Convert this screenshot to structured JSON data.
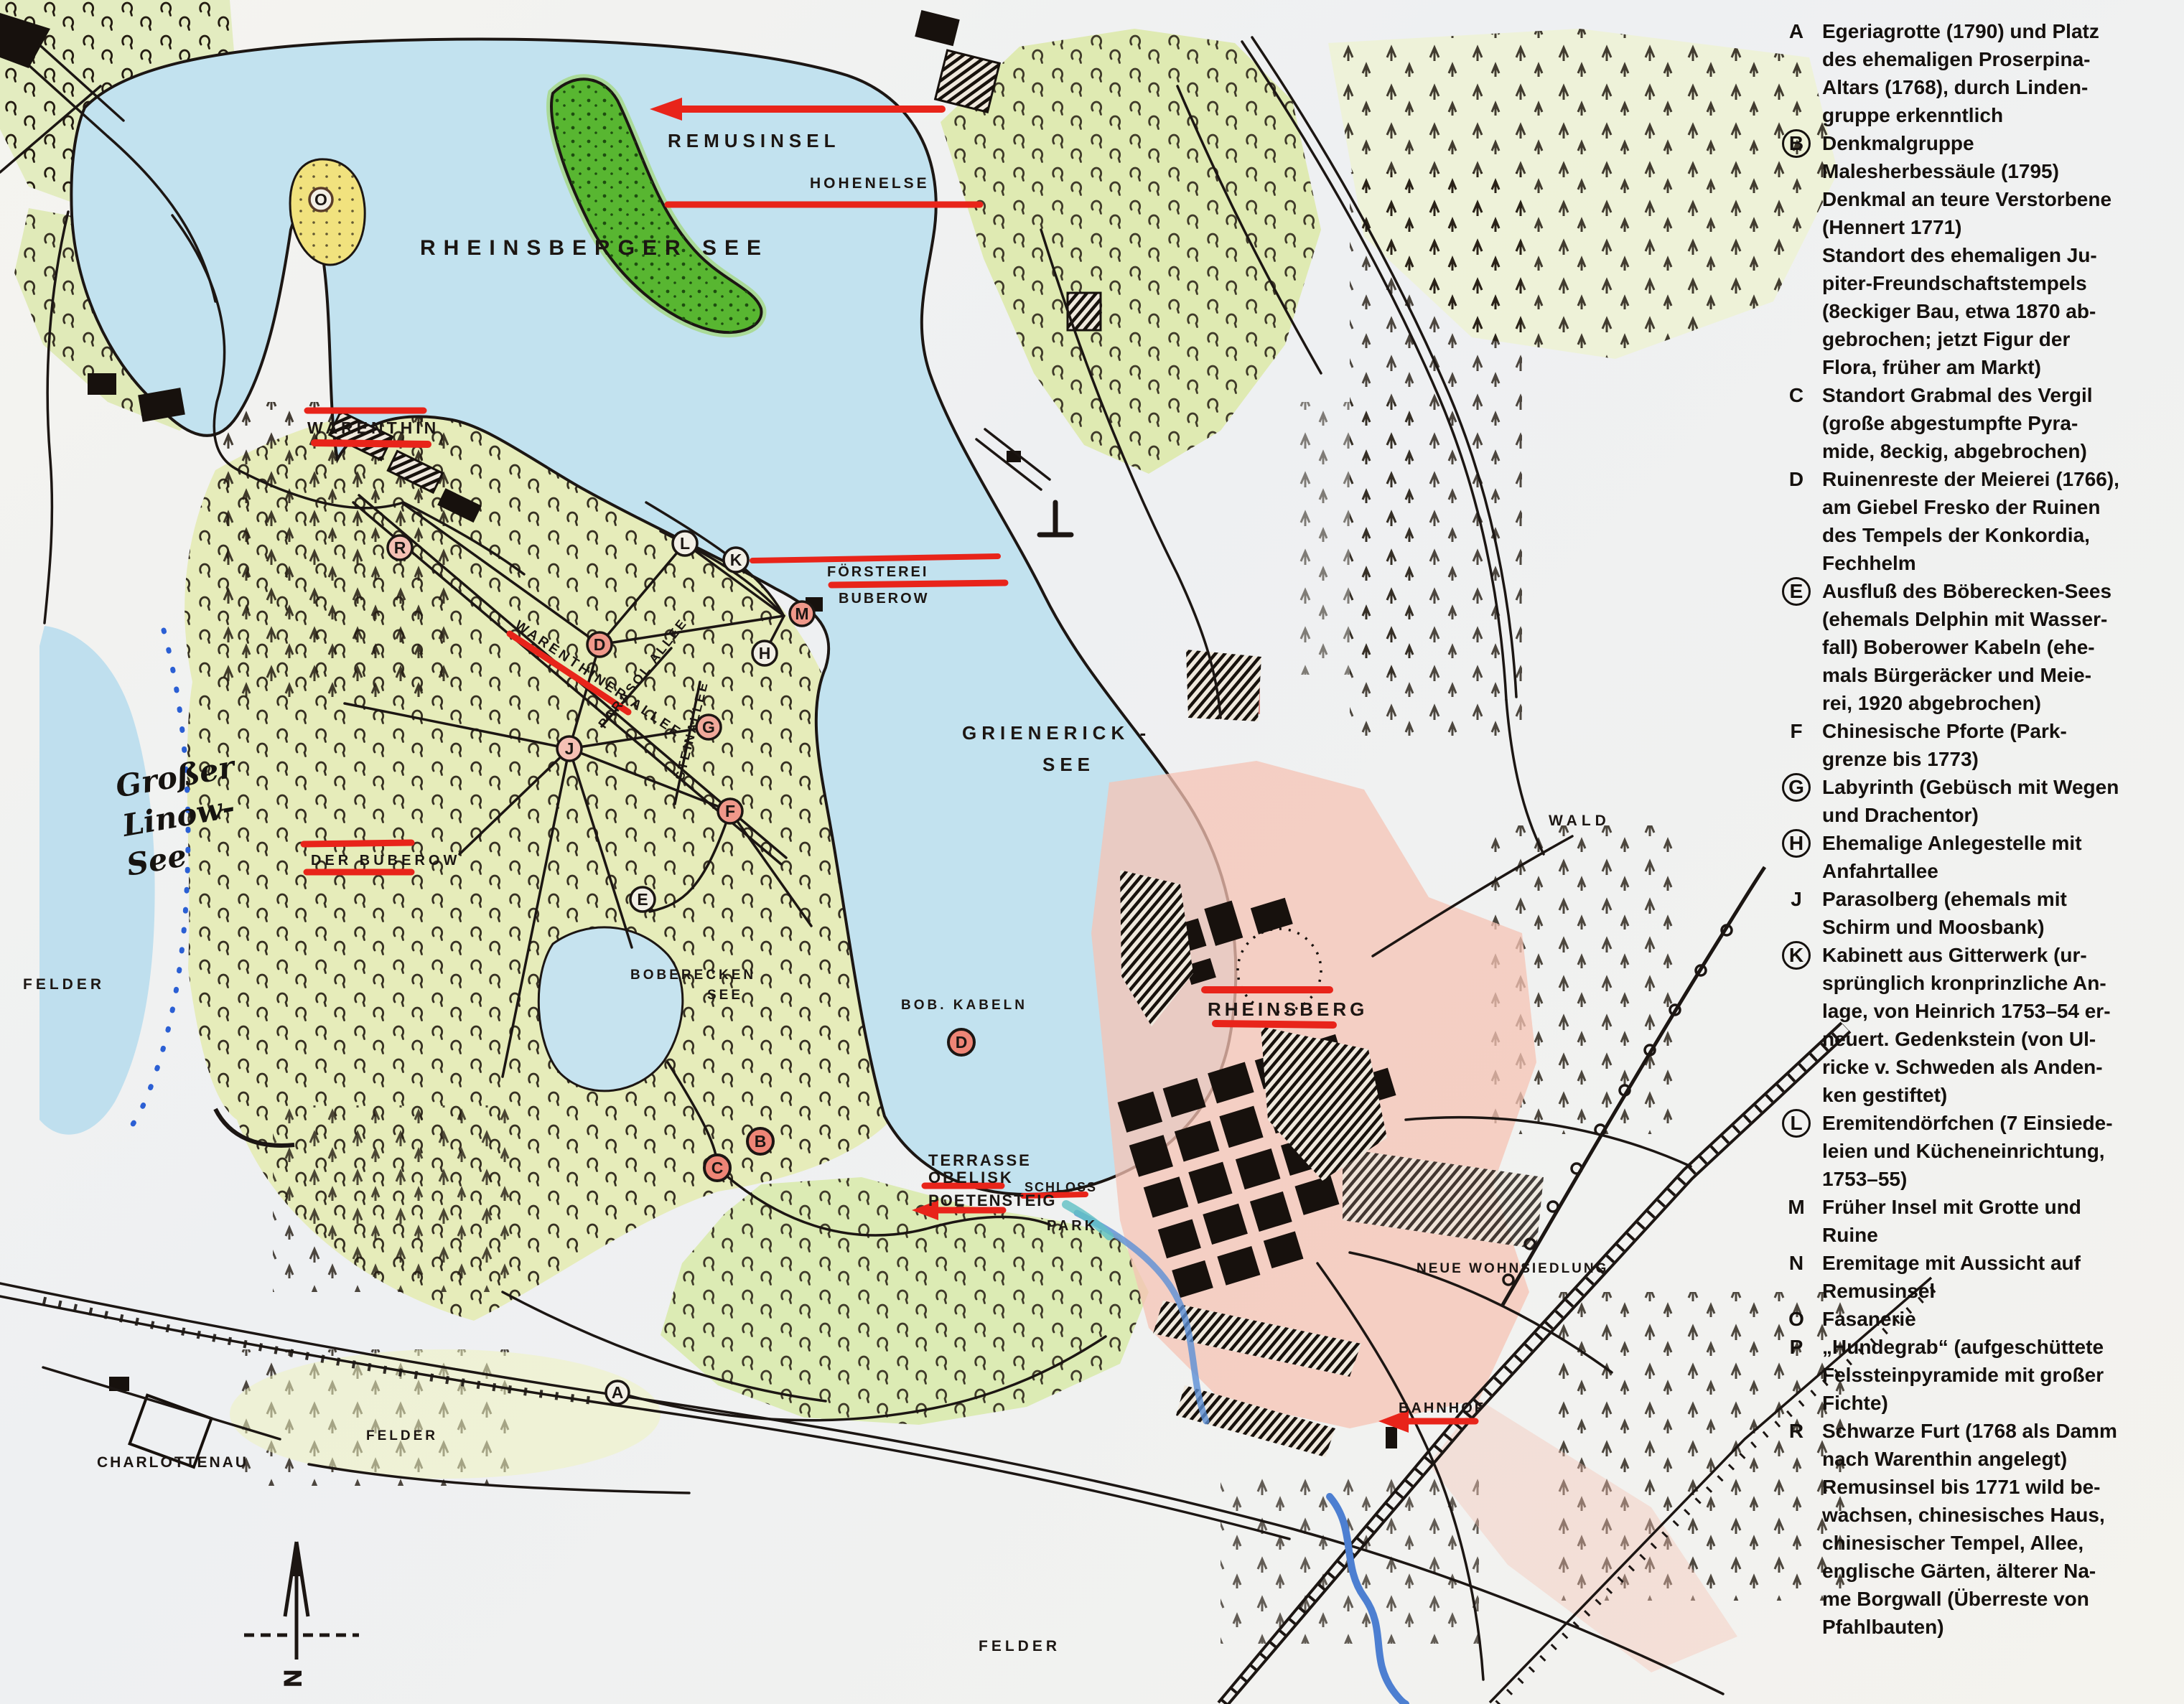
{
  "map": {
    "labels": {
      "remusinsel": "REMUSINSEL",
      "rheinsberger_see": "RHEINSBERGER  SEE",
      "hohenelse": "HOHENELSE",
      "warenthin": "WARENTHIN",
      "foersterei_line1": "FÖRSTEREI",
      "foersterei_line2": "BUBEROW",
      "warenthiner_allee": "WARENTHINER ALLEE",
      "parasol_allee": "PARASOL ALLEE",
      "steinallee": "STEINALLEE",
      "grienerick_line1": "GRIENERICK -",
      "grienerick_line2": "SEE",
      "grosser_linow_line1": "Großer",
      "grosser_linow_line2": "Linow-",
      "grosser_linow_line3": "See",
      "felder_west": "FELDER",
      "der_buberow": "DER  BUBEROW",
      "boberecken_line1": "BOBERECKEN",
      "boberecken_line2": "SEE",
      "bob_kabeln": "BOB. KABELN",
      "terrasse": "TERRASSE",
      "obelisk": "OBELISK",
      "poetensteig": "POETENSTEIG",
      "schloss": "SCHLOSS",
      "park": "PARK",
      "rheinsberg": "RHEINSBERG",
      "wald": "WALD",
      "neue_wohnsiedlung": "NEUE WOHNSIEDLUNG",
      "bahnhof": "BAHNHOF",
      "charlottenau": "CHARLOTTENAU",
      "felder_southwest": "FELDER",
      "felder_south": "FELDER",
      "north_letter": "N"
    },
    "markers": {
      "o": "O",
      "r": "R",
      "l": "L",
      "k": "K",
      "d_forest": "D",
      "m": "M",
      "h": "H",
      "g": "G",
      "j": "J",
      "f": "F",
      "e": "E",
      "d_lake": "D",
      "b": "B",
      "c": "C",
      "a": "A"
    },
    "colors": {
      "red_mark": "#e8241a",
      "water": "#c2e2ef",
      "forest": "#e6ecba",
      "island_green": "#58b631",
      "town_pink": "#f5c3b4",
      "sand": "#f1e27e",
      "ink": "#1c1613",
      "river_blue": "#4d7fd1"
    }
  },
  "legend": {
    "items": [
      {
        "letter": "A",
        "circled": false,
        "text": "Egeriagrotte (1790) und Platz\ndes ehemaligen Proserpina-\nAltars (1768), durch Linden-\ngruppe erkenntlich"
      },
      {
        "letter": "B",
        "circled": true,
        "text": "Denkmalgruppe\nMalesherbessäule (1795)\nDenkmal an teure Verstorbene\n(Hennert 1771)\nStandort des ehemaligen Ju-\npiter-Freundschaftstempels\n(8eckiger Bau, etwa 1870 ab-\ngebrochen; jetzt Figur der\nFlora, früher am Markt)"
      },
      {
        "letter": "C",
        "circled": false,
        "text": "Standort Grabmal des Vergil\n(große abgestumpfte Pyra-\nmide, 8eckig, abgebrochen)"
      },
      {
        "letter": "D",
        "circled": false,
        "text": "Ruinenreste der Meierei (1766),\nam Giebel Fresko der Ruinen\ndes Tempels der Konkordia,\nFechhelm"
      },
      {
        "letter": "E",
        "circled": true,
        "text": "Ausfluß des Böberecken-Sees\n(ehemals Delphin mit Wasser-\nfall) Boberower Kabeln (ehe-\nmals Bürgeräcker und Meie-\nrei, 1920 abgebrochen)"
      },
      {
        "letter": "F",
        "circled": false,
        "text": "Chinesische Pforte (Park-\ngrenze bis 1773)"
      },
      {
        "letter": "G",
        "circled": true,
        "text": "Labyrinth (Gebüsch mit Wegen\nund Drachentor)"
      },
      {
        "letter": "H",
        "circled": true,
        "text": "Ehemalige Anlegestelle mit\nAnfahrtallee"
      },
      {
        "letter": "J",
        "circled": false,
        "text": "Parasolberg (ehemals mit\nSchirm und Moosbank)"
      },
      {
        "letter": "K",
        "circled": true,
        "text": "Kabinett aus Gitterwerk (ur-\nsprünglich kronprinzliche An-\nlage, von Heinrich 1753–54 er-\nneuert. Gedenkstein (von Ul-\nricke v. Schweden als Anden-\nken gestiftet)"
      },
      {
        "letter": "L",
        "circled": true,
        "text": "Eremitendörfchen (7 Einsiede-\nleien und Kücheneinrichtung,\n1753–55)"
      },
      {
        "letter": "M",
        "circled": false,
        "text": "Früher Insel mit Grotte und\nRuine"
      },
      {
        "letter": "N",
        "circled": false,
        "text": "Eremitage mit Aussicht auf\nRemusinsel"
      },
      {
        "letter": "O",
        "circled": false,
        "text": "Fasanerie"
      },
      {
        "letter": "P",
        "circled": false,
        "text": "„Hundegrab“ (aufgeschüttete\nFelssteinpyramide mit großer\nFichte)"
      },
      {
        "letter": "R",
        "circled": false,
        "text": "Schwarze Furt (1768 als Damm\nnach Warenthin angelegt)\nRemusinsel bis 1771 wild be-\nwachsen, chinesisches Haus,\nchinesischer Tempel, Allee,\nenglische Gärten, älterer Na-\nme Borgwall (Überreste von\nPfahlbauten)"
      }
    ]
  }
}
